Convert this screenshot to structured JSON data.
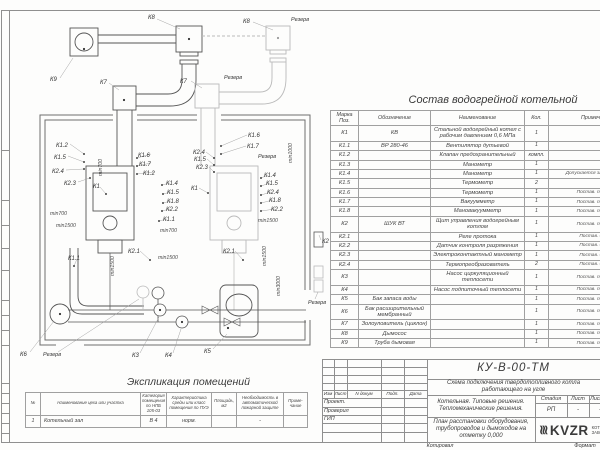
{
  "plan": {
    "tags": {
      "k1": "К1",
      "k1_1": "К1.1",
      "k1_2": "К1.2",
      "k1_4": "К1.4",
      "k1_5": "К1.5",
      "k1_6": "К1.6",
      "k1_7": "К1.7",
      "k1_8": "К1.8",
      "k2": "К2",
      "k2_1": "К2.1",
      "k2_2": "К2.2",
      "k2_3": "К2.3",
      "k2_4": "К2.4",
      "k3": "К3",
      "k4": "К4",
      "k5": "К5",
      "k6": "К6",
      "k7": "К7",
      "k8": "К8",
      "k9": "К9",
      "reserve": "Резерв",
      "min700": "min700",
      "min1000": "min1000",
      "min1500": "min1500",
      "min3000": "min3000"
    }
  },
  "spec_table": {
    "title": "Состав водогрейной котельной",
    "headers": [
      "Марка Поз.",
      "Обозначение",
      "Наименование",
      "Кол.",
      "Примечание"
    ],
    "rows": [
      {
        "mark": "К1",
        "code": "КВ",
        "name": "Стальной водогрейный котел с рабочим давлением 0,6 МПа",
        "qty": "1",
        "note": ""
      },
      {
        "mark": "К1.1",
        "code": "ВР 280-46",
        "name": "Вентилятор дутьевой",
        "qty": "1",
        "note": ""
      },
      {
        "mark": "К1.2",
        "code": "",
        "name": "Клапан предохранительный",
        "qty": "компл.",
        "note": ""
      },
      {
        "mark": "К1.3",
        "code": "",
        "name": "Манометр",
        "qty": "1",
        "note": ""
      },
      {
        "mark": "К1.4",
        "code": "",
        "name": "Манометр",
        "qty": "1",
        "note": "Допускается зам. поз. К2.3"
      },
      {
        "mark": "К1.5",
        "code": "",
        "name": "Термометр",
        "qty": "2",
        "note": ""
      },
      {
        "mark": "К1.6",
        "code": "",
        "name": "Термометр",
        "qty": "1",
        "note": "Постав. по согла"
      },
      {
        "mark": "К1.7",
        "code": "",
        "name": "Вакуумметр",
        "qty": "1",
        "note": "Постав. по согла"
      },
      {
        "mark": "К1.8",
        "code": "",
        "name": "Мановакуумметр",
        "qty": "1",
        "note": "Постав. по согла"
      },
      {
        "mark": "К2",
        "code": "ШУК ВТ",
        "name": "Щит управления водогрейным котлом",
        "qty": "1",
        "note": "Постав. по согла"
      },
      {
        "mark": "К2.1",
        "code": "",
        "name": "Реле протока",
        "qty": "1",
        "note": "Постав. с ШУК"
      },
      {
        "mark": "К2.2",
        "code": "",
        "name": "Датчик контроля разряжения",
        "qty": "1",
        "note": "Постав. с ШУК"
      },
      {
        "mark": "К2.3",
        "code": "",
        "name": "Электроконтактный манометр",
        "qty": "1",
        "note": "Постав. с ШУК"
      },
      {
        "mark": "К2.4",
        "code": "",
        "name": "Термопреобразователь",
        "qty": "2",
        "note": "Постав. с ШУК"
      },
      {
        "mark": "К3",
        "code": "",
        "name": "Насос циркуляционный теплосети",
        "qty": "1",
        "note": "Постав. по согла"
      },
      {
        "mark": "К4",
        "code": "",
        "name": "Насос подпиточный теплосети",
        "qty": "1",
        "note": "Постав. по согла"
      },
      {
        "mark": "К5",
        "code": "Бак запаса воды",
        "name": "",
        "qty": "1",
        "note": "Постав. по согла"
      },
      {
        "mark": "К6",
        "code": "Бак расширительный мембранный",
        "name": "",
        "qty": "1",
        "note": "Постав. по согла"
      },
      {
        "mark": "К7",
        "code": "Золоуловитель (циклон)",
        "name": "",
        "qty": "1",
        "note": "Постав. по согла"
      },
      {
        "mark": "К8",
        "code": "Дымосос",
        "name": "",
        "qty": "1",
        "note": "Постав. по согла"
      },
      {
        "mark": "К9",
        "code": "Труба дымовая",
        "name": "",
        "qty": "1",
        "note": "Постав. по согла"
      }
    ]
  },
  "room_table": {
    "title": "Экспликация помещений",
    "headers": [
      "№",
      "Наименование цеха или участка",
      "Категория помещения по НПБ 105-03",
      "Характеристика среды или класс помещения по ПУЭ",
      "Площадь, м2",
      "Необходимость в автоматической пожарной защите",
      "Приме- чание"
    ],
    "rows": [
      {
        "num": "1",
        "name": "Котельный зал",
        "cat": "В 4",
        "env": "норм.",
        "area": "",
        "fire": "-",
        "note": ""
      }
    ]
  },
  "title_block": {
    "doc_number": "КУ-В-00-ТМ",
    "doc_title": "Схема подключения твердотопливного котла работающего на угле",
    "rev_headers": [
      "Изм",
      "Лист",
      "N докум",
      "Подп.",
      "Дата"
    ],
    "role_1": "Проект.",
    "role_2": "Проверил",
    "role_3": "ГИП",
    "project": "Котельная. Типовые решения. Тепломеханические решения.",
    "sheet_title": "План расстановки оборудования, трубопроводов и дымоходов на отметку 0,000",
    "stage_headers": [
      "Стадия",
      "Лист",
      "Листов"
    ],
    "stage_values": [
      "РП",
      "-",
      "-"
    ],
    "logo_wave": "≋",
    "logo": "KVZR",
    "logo_cap_1": "КОТЕЛЬН",
    "logo_cap_2": "ЗАВОД Р",
    "copied": "Копировал",
    "format": "Формат"
  }
}
